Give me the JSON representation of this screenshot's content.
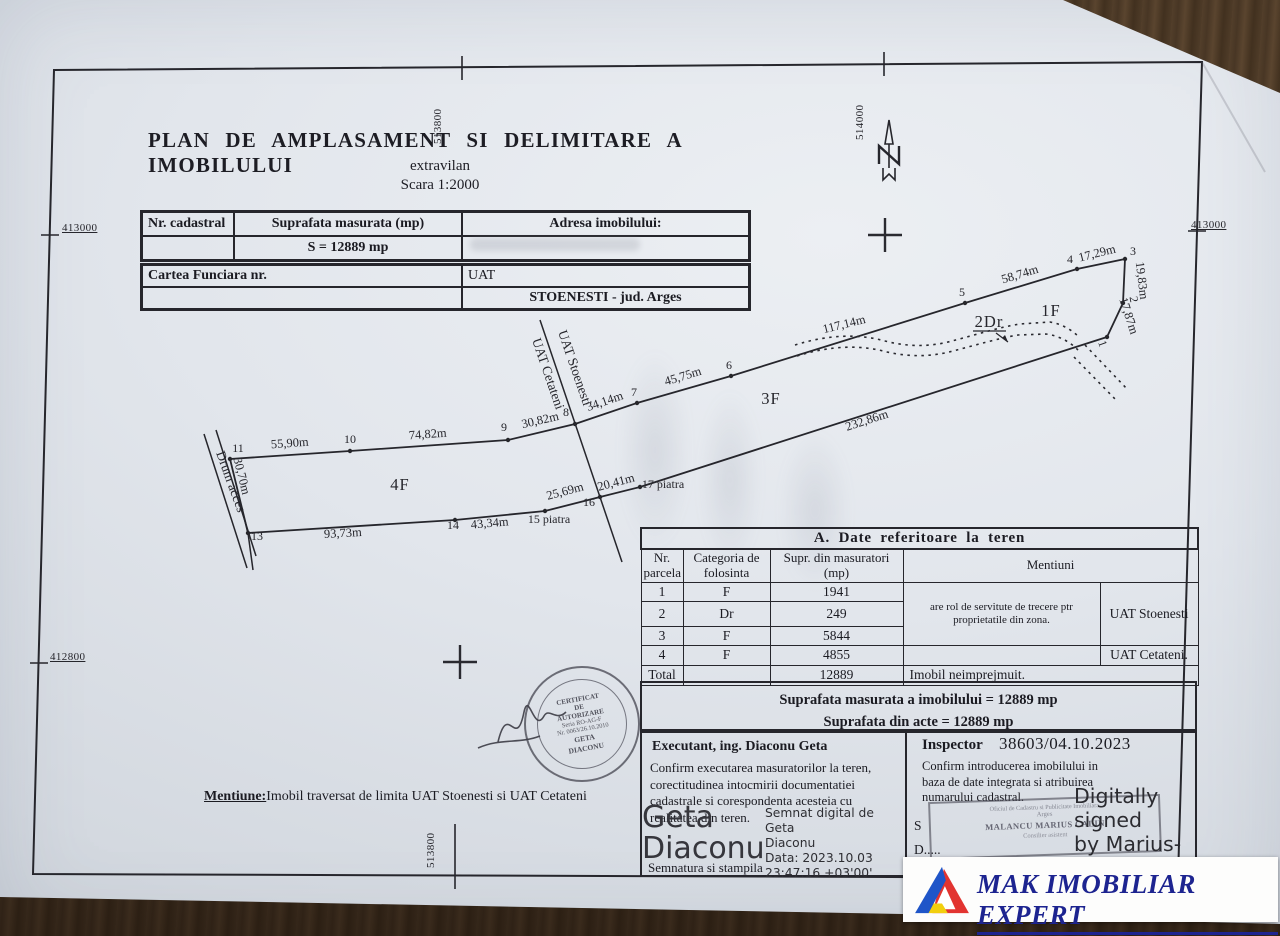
{
  "title_block": {
    "title": "PLAN DE AMPLASAMENT SI DELIMITARE A IMOBILULUI",
    "subtitle": "extravilan",
    "scale": "Scara 1:2000"
  },
  "coords": {
    "top_left": "513800",
    "top_right": "514000",
    "left_top": "413000",
    "left_bottom": "412800",
    "right": "413000",
    "bottom": "513800"
  },
  "id_table": {
    "c1": "Nr. cadastral",
    "c2": "Suprafata masurata (mp)",
    "c3": "Adresa  imobilului:",
    "area": "S = 12889 mp"
  },
  "cf_table": {
    "c1": "Cartea  Funciara  nr.",
    "c2": "UAT",
    "uat_value": "STOENESTI - jud. Arges"
  },
  "plan": {
    "measurements": [
      {
        "text": "55,90m",
        "x": 290,
        "y": 447,
        "rot": -4
      },
      {
        "text": "74,82m",
        "x": 428,
        "y": 438,
        "rot": -4
      },
      {
        "text": "30,82m",
        "x": 541,
        "y": 424,
        "rot": -13
      },
      {
        "text": "34,14m",
        "x": 606,
        "y": 405,
        "rot": -19
      },
      {
        "text": "45,75m",
        "x": 684,
        "y": 380,
        "rot": -17
      },
      {
        "text": "117,14m",
        "x": 845,
        "y": 328,
        "rot": -14
      },
      {
        "text": "58,74m",
        "x": 1021,
        "y": 278,
        "rot": -17
      },
      {
        "text": "17,29m",
        "x": 1098,
        "y": 257,
        "rot": -14
      },
      {
        "text": "19,83m",
        "x": 1138,
        "y": 281,
        "rot": 83
      },
      {
        "text": "17,87m",
        "x": 1125,
        "y": 317,
        "rot": 72
      },
      {
        "text": "232,86m",
        "x": 868,
        "y": 424,
        "rot": -18
      },
      {
        "text": "20,41m",
        "x": 617,
        "y": 486,
        "rot": -15
      },
      {
        "text": "25,69m",
        "x": 566,
        "y": 495,
        "rot": -15
      },
      {
        "text": "43,34m",
        "x": 490,
        "y": 527,
        "rot": -5
      },
      {
        "text": "93,73m",
        "x": 343,
        "y": 537,
        "rot": -3
      },
      {
        "text": "30,70m",
        "x": 238,
        "y": 477,
        "rot": 76
      }
    ],
    "points": [
      {
        "text": "11",
        "x": 238,
        "y": 452
      },
      {
        "text": "10",
        "x": 350,
        "y": 443
      },
      {
        "text": "9",
        "x": 504,
        "y": 431
      },
      {
        "text": "8",
        "x": 566,
        "y": 416
      },
      {
        "text": "7",
        "x": 634,
        "y": 396
      },
      {
        "text": "6",
        "x": 729,
        "y": 369
      },
      {
        "text": "5",
        "x": 962,
        "y": 296
      },
      {
        "text": "4",
        "x": 1070,
        "y": 263
      },
      {
        "text": "3",
        "x": 1133,
        "y": 255
      },
      {
        "text": "2",
        "x": 1130,
        "y": 300,
        "rot": 80
      },
      {
        "text": "1",
        "x": 1099,
        "y": 345,
        "rot": 70
      },
      {
        "text": "13",
        "x": 257,
        "y": 540
      },
      {
        "text": "14",
        "x": 453,
        "y": 529
      },
      {
        "text": "15 piatra",
        "x": 549,
        "y": 523
      },
      {
        "text": "16",
        "x": 589,
        "y": 506
      },
      {
        "text": "17 piatra",
        "x": 663,
        "y": 488
      }
    ],
    "regions": [
      {
        "text": "4F",
        "x": 400,
        "y": 490
      },
      {
        "text": "3F",
        "x": 771,
        "y": 404
      },
      {
        "text": "1F",
        "x": 1051,
        "y": 316
      },
      {
        "text": "2Dr",
        "x": 989,
        "y": 327
      }
    ],
    "boundary_labels": [
      {
        "text": "UAT Stoenesti",
        "x": 558,
        "y": 332,
        "rot": 71
      },
      {
        "text": "UAT Cetateni",
        "x": 532,
        "y": 340,
        "rot": 71
      }
    ],
    "road_label": {
      "text": "Drum acces",
      "x": 216,
      "y": 453,
      "rot": 70
    }
  },
  "table_a": {
    "title": "A.  Date  referitoare  la  teren",
    "headers": {
      "nr": "Nr.\nparcela",
      "cat": "Categoria de\nfolosinta",
      "supr": "Supr. din masuratori\n(mp)",
      "ment": "Mentiuni"
    },
    "rows": [
      {
        "nr": "1",
        "cat": "F",
        "supr": "1941"
      },
      {
        "nr": "2",
        "cat": "Dr",
        "supr": "249"
      },
      {
        "nr": "3",
        "cat": "F",
        "supr": "5844"
      },
      {
        "nr": "4",
        "cat": "F",
        "supr": "4855",
        "ment_right": "UAT Cetateni."
      }
    ],
    "servitute_note": "are rol de servitute  de trecere ptr\nproprietatile din zona.",
    "uat_right_123": "UAT Stoenesti",
    "total_label": "Total",
    "total_value": "12889",
    "total_note": "Imobil neimprejmuit."
  },
  "areas_block": {
    "line1": "Suprafata masurata a imobilului = 12889 mp",
    "line2": "Suprafata din acte = 12889 mp"
  },
  "executant": {
    "heading": "Executant, ing. Diaconu Geta",
    "body": "Confirm executarea masuratorilor la teren,\ncorectitudinea intocmirii documentatiei\ncadastrale si corespondenta acesteia cu\nrealitatea din teren.",
    "signature_name": "Geta\nDiaconu",
    "signature_details": "Semnat digital de Geta\nDiaconu\nData: 2023.10.03\n23:47:16 +03'00'",
    "footer": "Semnatura si stampila"
  },
  "inspector": {
    "heading": "Inspector",
    "number": "38603/04.10.2023",
    "body": "Confirm introducerea imobilului in\nbaza de date integrata si atribuirea\nnumarului cadastral.",
    "partial_semnatura": "S",
    "partial_data": "D.....",
    "partial_stampila": "Stampila BCPI",
    "digital_signature": "Digitally signed\nby Marius-Calin\nMalancu",
    "stamp": {
      "l1": "Oficiul de Cadastru si Publicitate Imobiliara",
      "l2": "Arges",
      "l3": "MALANCU MARIUS CALIN",
      "l4": "Consilier asistent"
    }
  },
  "round_stamp": {
    "lines": [
      "CERTIFICAT",
      "DE",
      "AUTORIZARE",
      "Seria RO-AG-F",
      "Nr. 0063/26.10.2010",
      "GETA",
      "DIACONU"
    ]
  },
  "mentiune": {
    "label": "Mentiune:",
    "text": "Imobil traversat de limita  UAT Stoenesti si UAT Cetateni"
  },
  "logo": {
    "text": "MAK IMOBILIAR EXPERT",
    "navy": "#1d2490",
    "blue": "#1f55c8",
    "yellow": "#f2cf0e",
    "red": "#e23430"
  }
}
